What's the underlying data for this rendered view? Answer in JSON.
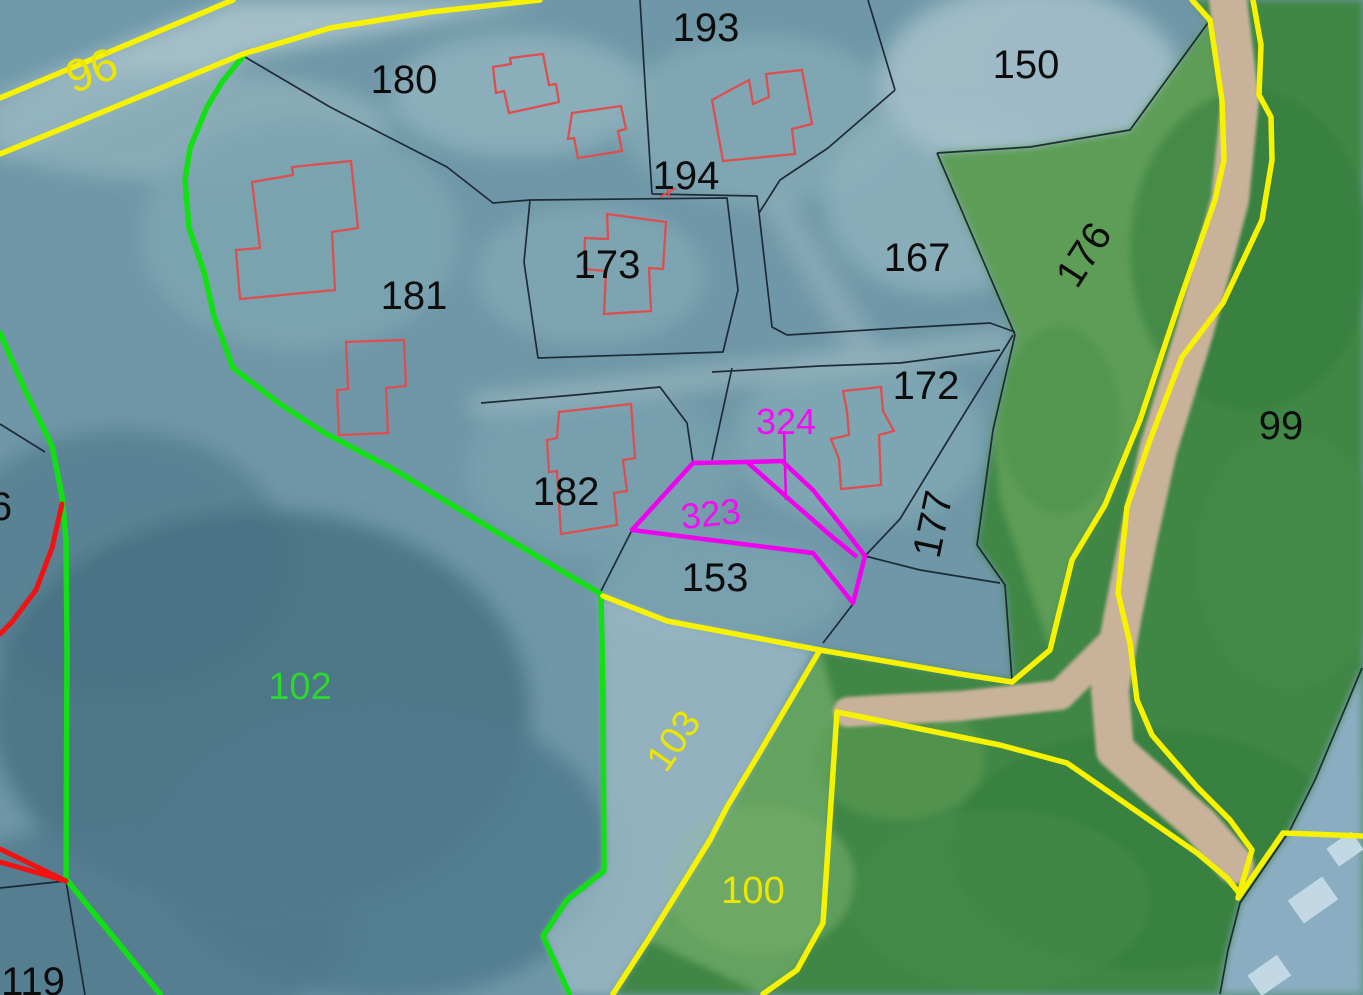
{
  "map": {
    "description": "Cadastral parcel map over aerial imagery",
    "colors": {
      "boundary_yellow": "#f7f200",
      "boundary_green": "#12e012",
      "parcel_magenta": "#ef00ef",
      "building_outline_red": "#dd4f4f",
      "emphasis_red": "#f21212",
      "parcel_line_black": "#16222e",
      "label_black": "#0c0c0c",
      "label_yellow": "#ece600",
      "label_green": "#2fd62f",
      "label_magenta": "#f20df2",
      "forest_green_fill": "#3f8644",
      "path_tan_fill": "#c9b29a",
      "aerial_teal_fill": "#6f97a7"
    },
    "labels": [
      {
        "text": "96",
        "x": 97,
        "y": 85,
        "rotation": -20,
        "color": "#ece600",
        "size": 46
      },
      {
        "text": "180",
        "x": 404,
        "y": 93,
        "rotation": 0,
        "color": "#0c0c0c",
        "size": 40
      },
      {
        "text": "193",
        "x": 706,
        "y": 41,
        "rotation": 0,
        "color": "#0c0c0c",
        "size": 40
      },
      {
        "text": "150",
        "x": 1026,
        "y": 78,
        "rotation": 0,
        "color": "#0c0c0c",
        "size": 40
      },
      {
        "text": "194",
        "x": 686,
        "y": 189,
        "rotation": 0,
        "color": "#0c0c0c",
        "size": 40
      },
      {
        "text": "173",
        "x": 607,
        "y": 278,
        "rotation": 0,
        "color": "#0c0c0c",
        "size": 40
      },
      {
        "text": "167",
        "x": 917,
        "y": 271,
        "rotation": 0,
        "color": "#0c0c0c",
        "size": 40
      },
      {
        "text": "176",
        "x": 1095,
        "y": 262,
        "rotation": -57,
        "color": "#0c0c0c",
        "size": 40
      },
      {
        "text": "181",
        "x": 414,
        "y": 309,
        "rotation": 0,
        "color": "#0c0c0c",
        "size": 40
      },
      {
        "text": "172",
        "x": 926,
        "y": 399,
        "rotation": 0,
        "color": "#0c0c0c",
        "size": 40
      },
      {
        "text": "99",
        "x": 1281,
        "y": 439,
        "rotation": 0,
        "color": "#0c0c0c",
        "size": 40
      },
      {
        "text": "324",
        "x": 786,
        "y": 434,
        "rotation": 0,
        "color": "#f20df2",
        "size": 36
      },
      {
        "text": "182",
        "x": 566,
        "y": 505,
        "rotation": 0,
        "color": "#0c0c0c",
        "size": 40
      },
      {
        "text": "323",
        "x": 712,
        "y": 526,
        "rotation": -6,
        "color": "#f20df2",
        "size": 36
      },
      {
        "text": "177",
        "x": 946,
        "y": 527,
        "rotation": -78,
        "color": "#0c0c0c",
        "size": 40
      },
      {
        "text": "153",
        "x": 715,
        "y": 591,
        "rotation": 0,
        "color": "#0c0c0c",
        "size": 40
      },
      {
        "text": "102",
        "x": 300,
        "y": 699,
        "rotation": 0,
        "color": "#2fd62f",
        "size": 38
      },
      {
        "text": "103",
        "x": 684,
        "y": 748,
        "rotation": -55,
        "color": "#ece600",
        "size": 38
      },
      {
        "text": "100",
        "x": 753,
        "y": 903,
        "rotation": 0,
        "color": "#ece600",
        "size": 38
      },
      {
        "text": "119",
        "x": 33,
        "y": 995,
        "rotation": 0,
        "color": "#0c0c0c",
        "size": 40
      },
      {
        "text": "6",
        "x": 1,
        "y": 520,
        "rotation": 0,
        "color": "#0c0c0c",
        "size": 40
      }
    ]
  }
}
